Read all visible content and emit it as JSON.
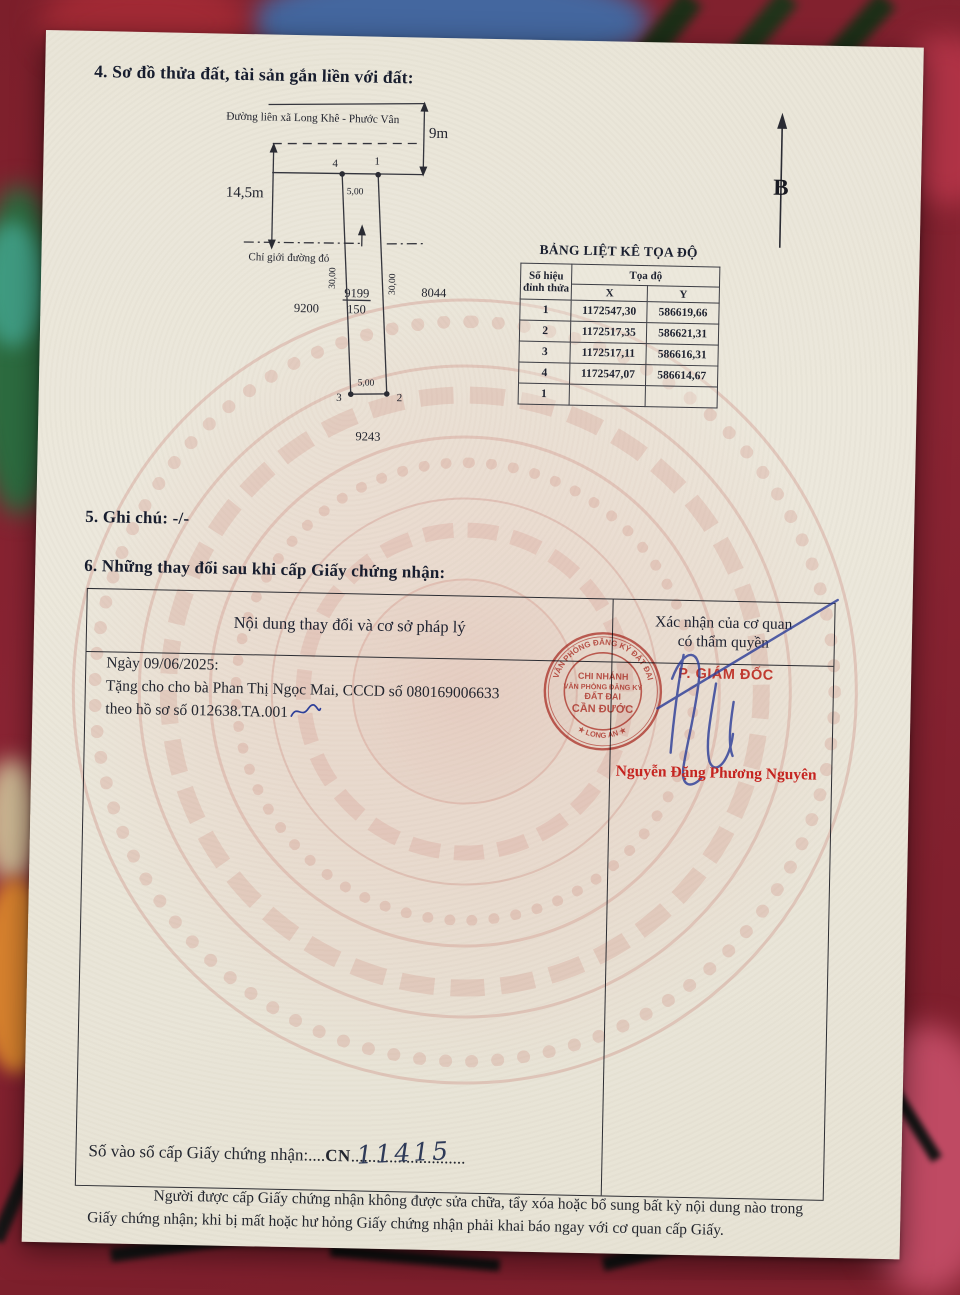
{
  "sections": {
    "s4_title": "4. Sơ đồ thửa đất, tài sản gắn liền với đất:",
    "s5_text": "5. Ghi chú: -/-",
    "s6_title": "6. Những thay đổi sau khi cấp Giấy chứng nhận:"
  },
  "diagram": {
    "road_label": "Đường liên xã Long Khê - Phước Vân",
    "red_boundary_label": "Chỉ giới đường đỏ",
    "north_label": "B",
    "dim_road": "9m",
    "dim_frontage": "14,5m",
    "dim_top": "5,00",
    "dim_bottom": "5,00",
    "dim_side_left": "30,00",
    "dim_side_right": "30,00",
    "parcel_number": "9199",
    "parcel_area": "150",
    "neighbor_left": "9200",
    "neighbor_right": "8044",
    "neighbor_bottom": "9243",
    "vertex_top_left": "4",
    "vertex_top_right": "1",
    "vertex_bottom_left": "3",
    "vertex_bottom_right": "2"
  },
  "coord_table": {
    "title": "BẢNG LIỆT KÊ TỌA ĐỘ",
    "header_no_line1": "Số hiệu",
    "header_no_line2": "đỉnh thửa",
    "header_coord": "Tọa độ",
    "header_x": "X",
    "header_y": "Y",
    "rows": [
      {
        "no": "1",
        "x": "1172547,30",
        "y": "586619,66"
      },
      {
        "no": "2",
        "x": "1172517,35",
        "y": "586621,31"
      },
      {
        "no": "3",
        "x": "1172517,11",
        "y": "586616,31"
      },
      {
        "no": "4",
        "x": "1172547,07",
        "y": "586614,67"
      },
      {
        "no": "1",
        "x": "",
        "y": ""
      }
    ]
  },
  "changes": {
    "header_left": "Nội dung thay đổi và cơ sở pháp lý",
    "header_right_line1": "Xác nhận của cơ quan",
    "header_right_line2": "có thẩm quyền",
    "entry_date": "Ngày 09/06/2025:",
    "entry_line2": "Tặng cho cho bà Phan Thị Ngọc Mai, CCCD số 080169006633",
    "entry_line3": "theo hồ sơ số 012638.TA.001",
    "stamp": {
      "ring_top": "VĂN PHÒNG ĐĂNG KÝ ĐẤT ĐAI",
      "ring_bottom": "★ LONG AN ★",
      "line1": "CHI NHÁNH",
      "line2": "VĂN PHÒNG ĐĂNG KÝ",
      "line3": "ĐẤT ĐAI",
      "line4": "CẦN ĐƯỚC"
    },
    "signer_title": "P. GIÁM ĐỐC",
    "signer_name": "Nguyễn Đặng Phương Nguyên"
  },
  "footer": {
    "register_label": "Số vào sổ cấp Giấy chứng nhận:",
    "register_dots1": "....",
    "register_prefix": "CN",
    "register_dots2": "...........................",
    "register_number": "11415",
    "notice_line1": "Người được cấp Giấy chứng nhận không được sửa chữa, tẩy xóa hoặc bổ sung bất kỳ nội dung nào trong",
    "notice_line2": "Giấy chứng nhận; khi bị mất hoặc hư hỏng Giấy chứng nhận phải khai báo ngay với cơ quan cấp Giấy."
  },
  "colors": {
    "stamp_red": "#bf4038",
    "name_red": "#c52420",
    "signature_blue": "#2e3f99",
    "paper": "#e9e5d8",
    "carpet_red": "#7c1f2b"
  }
}
